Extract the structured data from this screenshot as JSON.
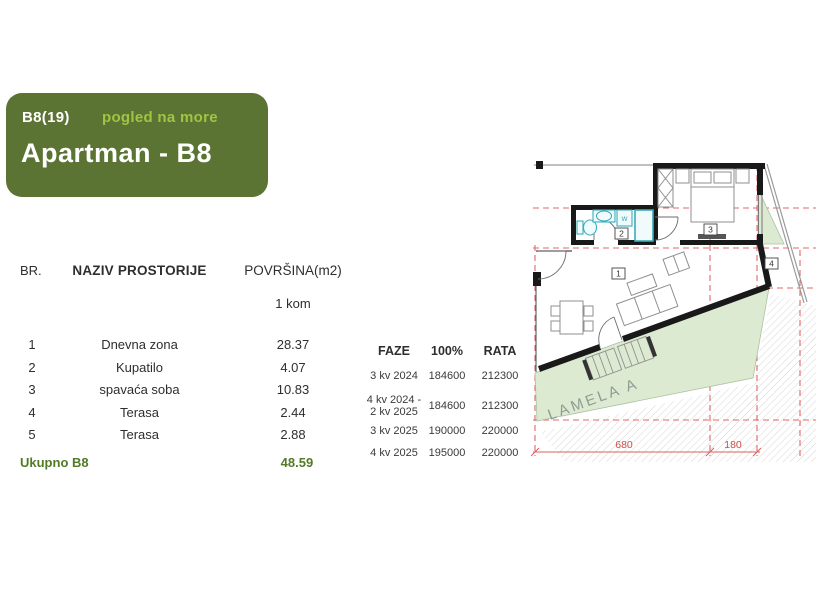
{
  "header_card": {
    "unit_code": "B8(19)",
    "view_note": "pogled na more",
    "title": "Apartman - B8"
  },
  "room_table": {
    "col_br": "BR.",
    "col_name": "NAZIV PROSTORIJE",
    "col_area": "POVRŠINA(m2)",
    "unit_count_label": "1 kom",
    "rows": [
      {
        "br": "1",
        "name": "Dnevna zona",
        "area": "28.37"
      },
      {
        "br": "2",
        "name": "Kupatilo",
        "area": "4.07"
      },
      {
        "br": "3",
        "name": "spavaća soba",
        "area": "10.83"
      },
      {
        "br": "4",
        "name": "Terasa",
        "area": "2.44"
      },
      {
        "br": "5",
        "name": "Terasa",
        "area": "2.88"
      }
    ],
    "total_label": "Ukupno B8",
    "total_area": "48.59"
  },
  "price_table": {
    "col_faze": "FAZE",
    "col_full": "100%",
    "col_rata": "RATA",
    "rows": [
      {
        "faze_lines": [
          "3 kv 2024"
        ],
        "full": "184600",
        "rata": "212300"
      },
      {
        "faze_lines": [
          "4 kv 2024 -",
          "2 kv 2025"
        ],
        "full": "184600",
        "rata": "212300"
      },
      {
        "faze_lines": [
          "3 kv 2025"
        ],
        "full": "190000",
        "rata": "220000"
      },
      {
        "faze_lines": [
          "4 kv 2025"
        ],
        "full": "195000",
        "rata": "220000"
      }
    ]
  },
  "floor_plan": {
    "label_living": "1",
    "label_bath": "2",
    "label_bedroom": "3",
    "label_terrace": "4",
    "washer_label": "w",
    "area_label": "LAMELA A",
    "dim_main": "680",
    "dim_side": "180"
  },
  "colors": {
    "header_green": "#5c7433",
    "accent_green": "#a3c342",
    "total_green": "#527b27",
    "wall_black": "#191919",
    "fixture_teal": "#3aacba",
    "terrace_green": "#dcead1",
    "grid_red": "#e06868",
    "dim_red": "#cf4b4b"
  }
}
